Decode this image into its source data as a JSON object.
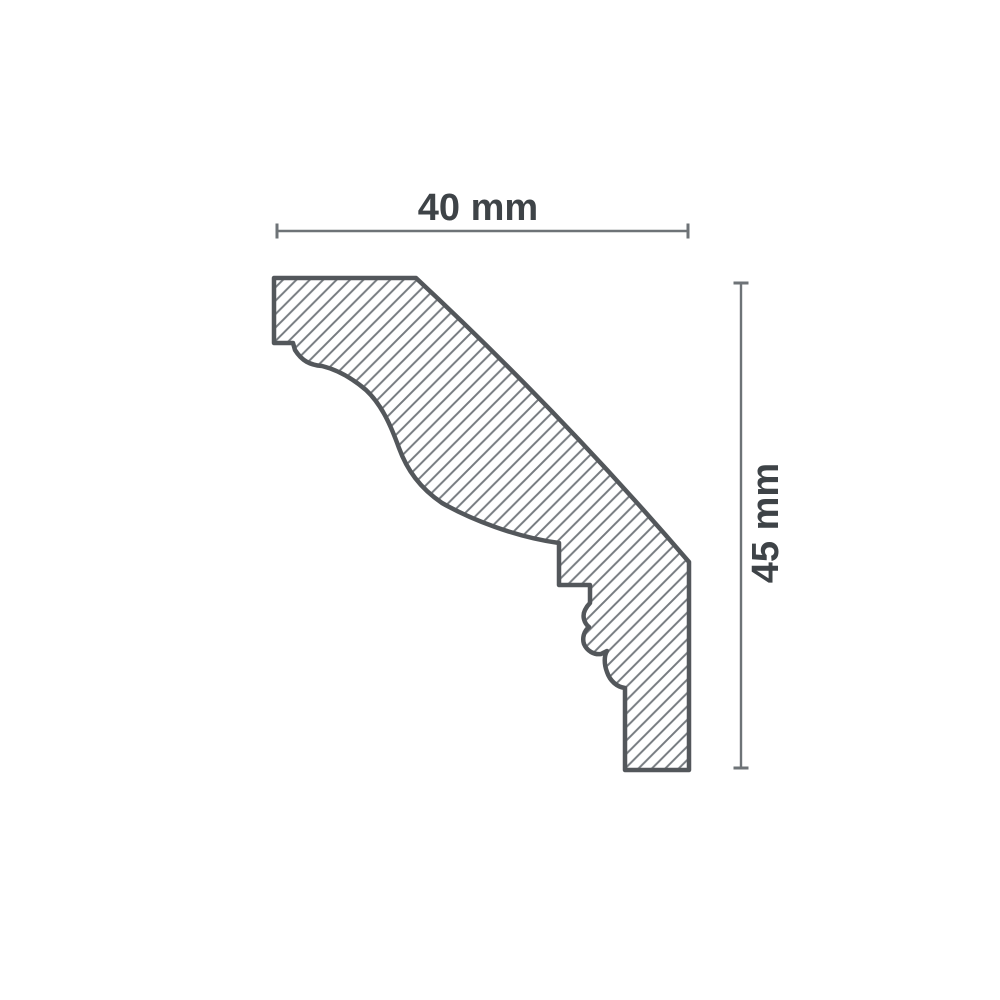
{
  "diagram": {
    "kind": "technical profile cross-section",
    "subject": "cornice-molding-profile",
    "hatch": "diagonal-lines",
    "dimensions": {
      "width": {
        "label": "40 mm",
        "value": 40,
        "unit": "mm"
      },
      "height": {
        "label": "45 mm",
        "value": 45,
        "unit": "mm"
      }
    },
    "colors": {
      "background": "#ffffff",
      "outline": "#53575b",
      "hatch_line": "#767b80",
      "dimension_line": "#6e7377",
      "text": "#3e4347"
    }
  }
}
